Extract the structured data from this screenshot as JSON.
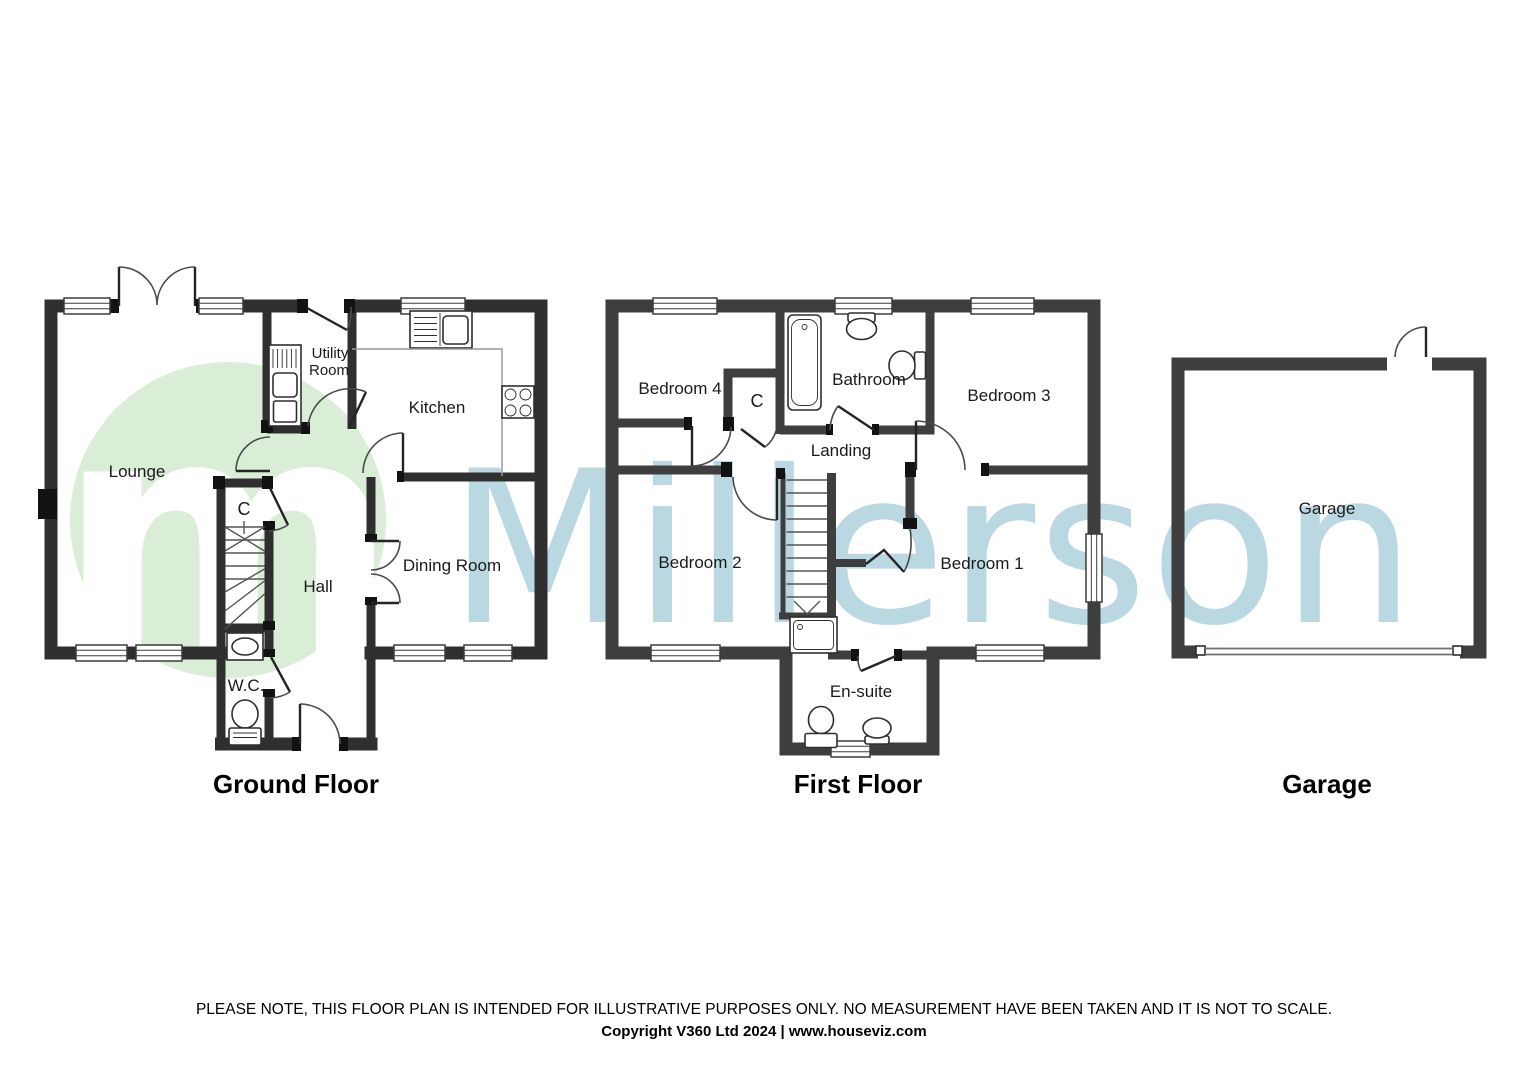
{
  "watermark": {
    "brand_text": "Millerson",
    "logo_letter": "m",
    "brand_color": "#b9d8e1",
    "logo_circle_color": "#daeed7"
  },
  "floors": {
    "ground": {
      "title": "Ground Floor",
      "labels": {
        "lounge": "Lounge",
        "utility_line1": "Utility",
        "utility_line2": "Room",
        "kitchen": "Kitchen",
        "cupboard": "C",
        "hall": "Hall",
        "dining": "Dining Room",
        "wc": "W.C."
      }
    },
    "first": {
      "title": "First Floor",
      "labels": {
        "bedroom4": "Bedroom 4",
        "cupboard": "C",
        "bathroom": "Bathroom",
        "bedroom3": "Bedroom 3",
        "landing": "Landing",
        "bedroom2": "Bedroom 2",
        "bedroom1": "Bedroom 1",
        "ensuite": "En-suite"
      }
    },
    "garage": {
      "title": "Garage",
      "labels": {
        "garage": "Garage"
      }
    }
  },
  "footer": {
    "disclaimer": "PLEASE NOTE, THIS FLOOR PLAN IS INTENDED FOR ILLUSTRATIVE PURPOSES ONLY. NO MEASUREMENT HAVE BEEN TAKEN AND IT IS NOT TO SCALE.",
    "copyright": "Copyright V360 Ltd 2024 | www.houseviz.com"
  }
}
